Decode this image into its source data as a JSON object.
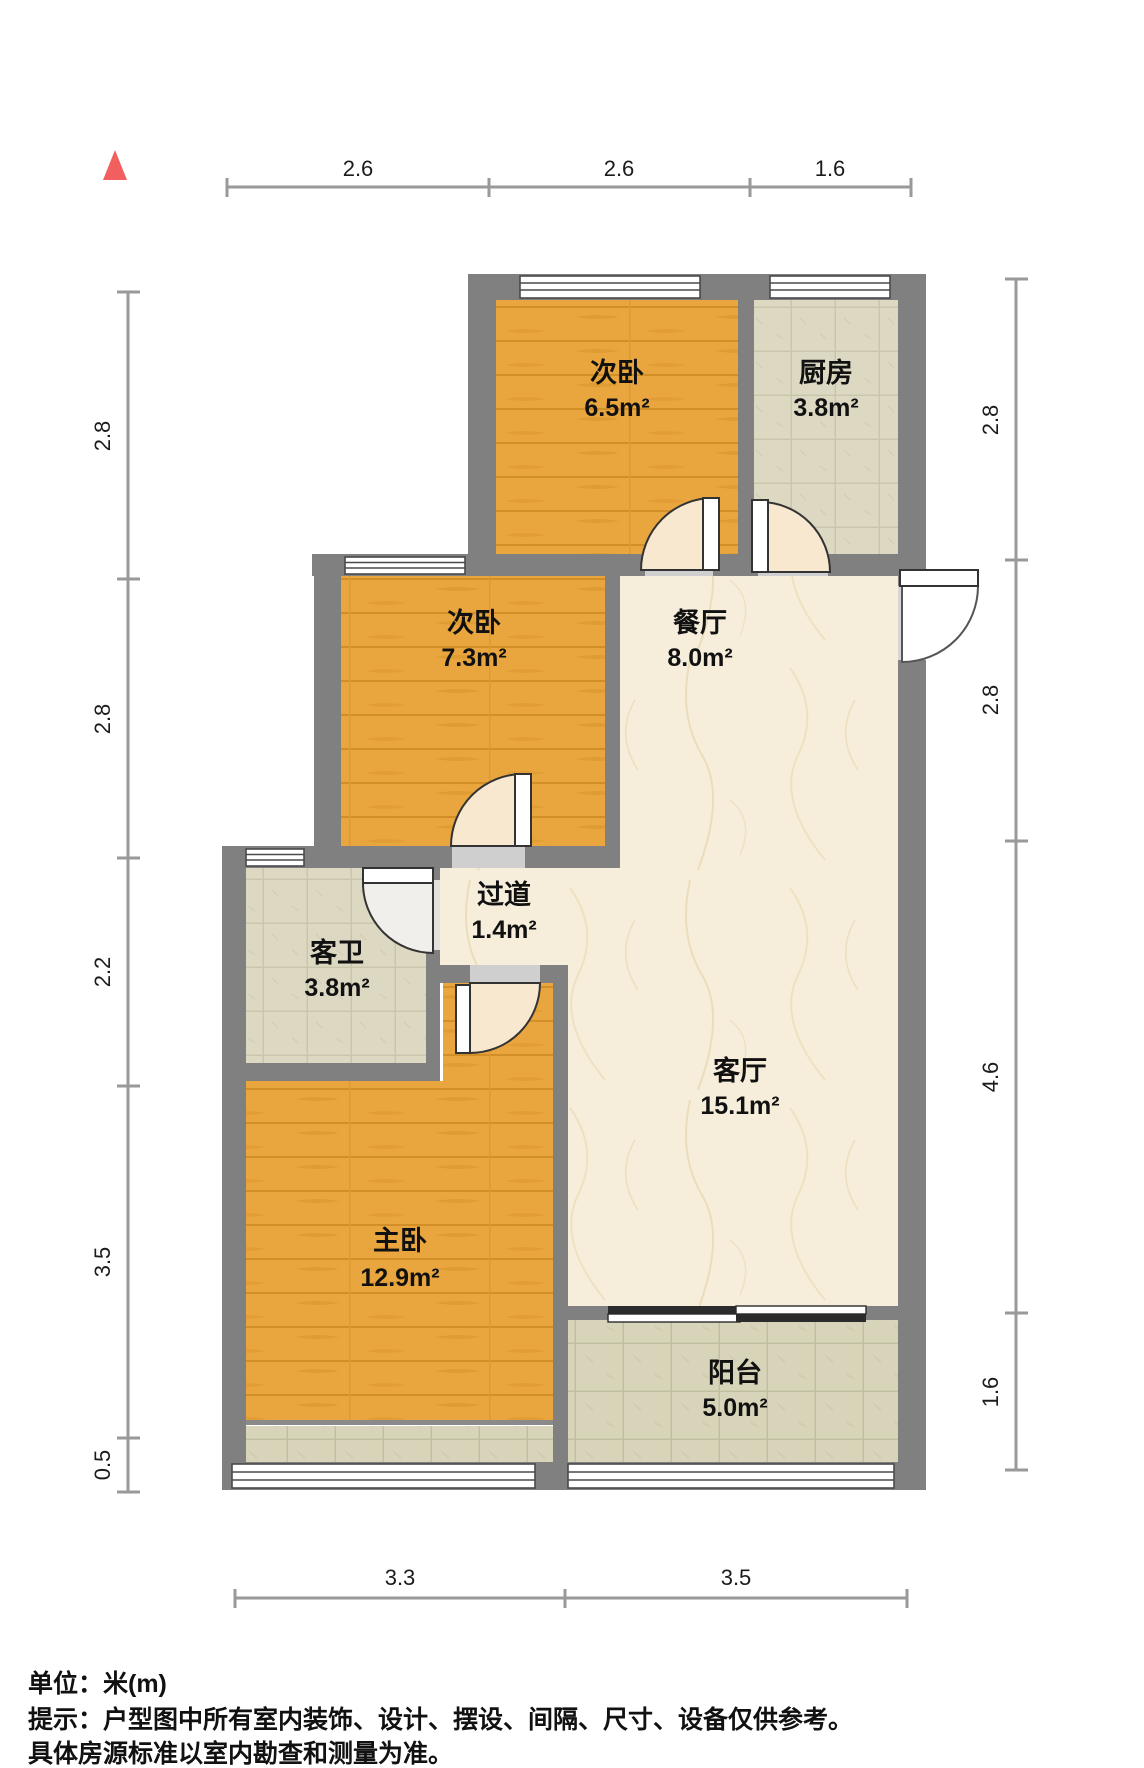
{
  "compass": {
    "icon": "north-arrow",
    "color": "#f15f5f"
  },
  "rooms": [
    {
      "id": "bedroom-second-top",
      "name": "次卧",
      "area": "6.5m²"
    },
    {
      "id": "kitchen",
      "name": "厨房",
      "area": "3.8m²"
    },
    {
      "id": "bedroom-second-mid",
      "name": "次卧",
      "area": "7.3m²"
    },
    {
      "id": "dining-room",
      "name": "餐厅",
      "area": "8.0m²"
    },
    {
      "id": "hallway",
      "name": "过道",
      "area": "1.4m²"
    },
    {
      "id": "guest-bathroom",
      "name": "客卫",
      "area": "3.8m²"
    },
    {
      "id": "living-room",
      "name": "客厅",
      "area": "15.1m²"
    },
    {
      "id": "master-bedroom",
      "name": "主卧",
      "area": "12.9m²"
    },
    {
      "id": "balcony",
      "name": "阳台",
      "area": "5.0m²"
    }
  ],
  "dimensions": {
    "top": [
      "2.6",
      "2.6",
      "1.6"
    ],
    "left": [
      "2.8",
      "2.8",
      "2.2",
      "3.5",
      "0.5"
    ],
    "right": [
      "2.8",
      "2.8",
      "4.6",
      "1.6"
    ],
    "bottom": [
      "3.3",
      "3.5"
    ]
  },
  "notes": {
    "unit": "单位：米(m)",
    "disclaimer1": "提示：户型图中所有室内装饰、设计、摆设、间隔、尺寸、设备仅供参考。",
    "disclaimer2": "具体房源标准以室内勘查和测量为准。"
  },
  "palette": {
    "wall": "#808080",
    "wood": "#e9a63e",
    "wood_grain": "#d28f28",
    "marble": "#f6eedb",
    "marble_vein": "#e8d6ae",
    "tile": "#dcd8c2",
    "tile_line": "#c9c5ab",
    "balcony_tile": "#d7d4b9",
    "balcony_tile_line": "#c1be9f",
    "dimension_line": "#999999"
  }
}
